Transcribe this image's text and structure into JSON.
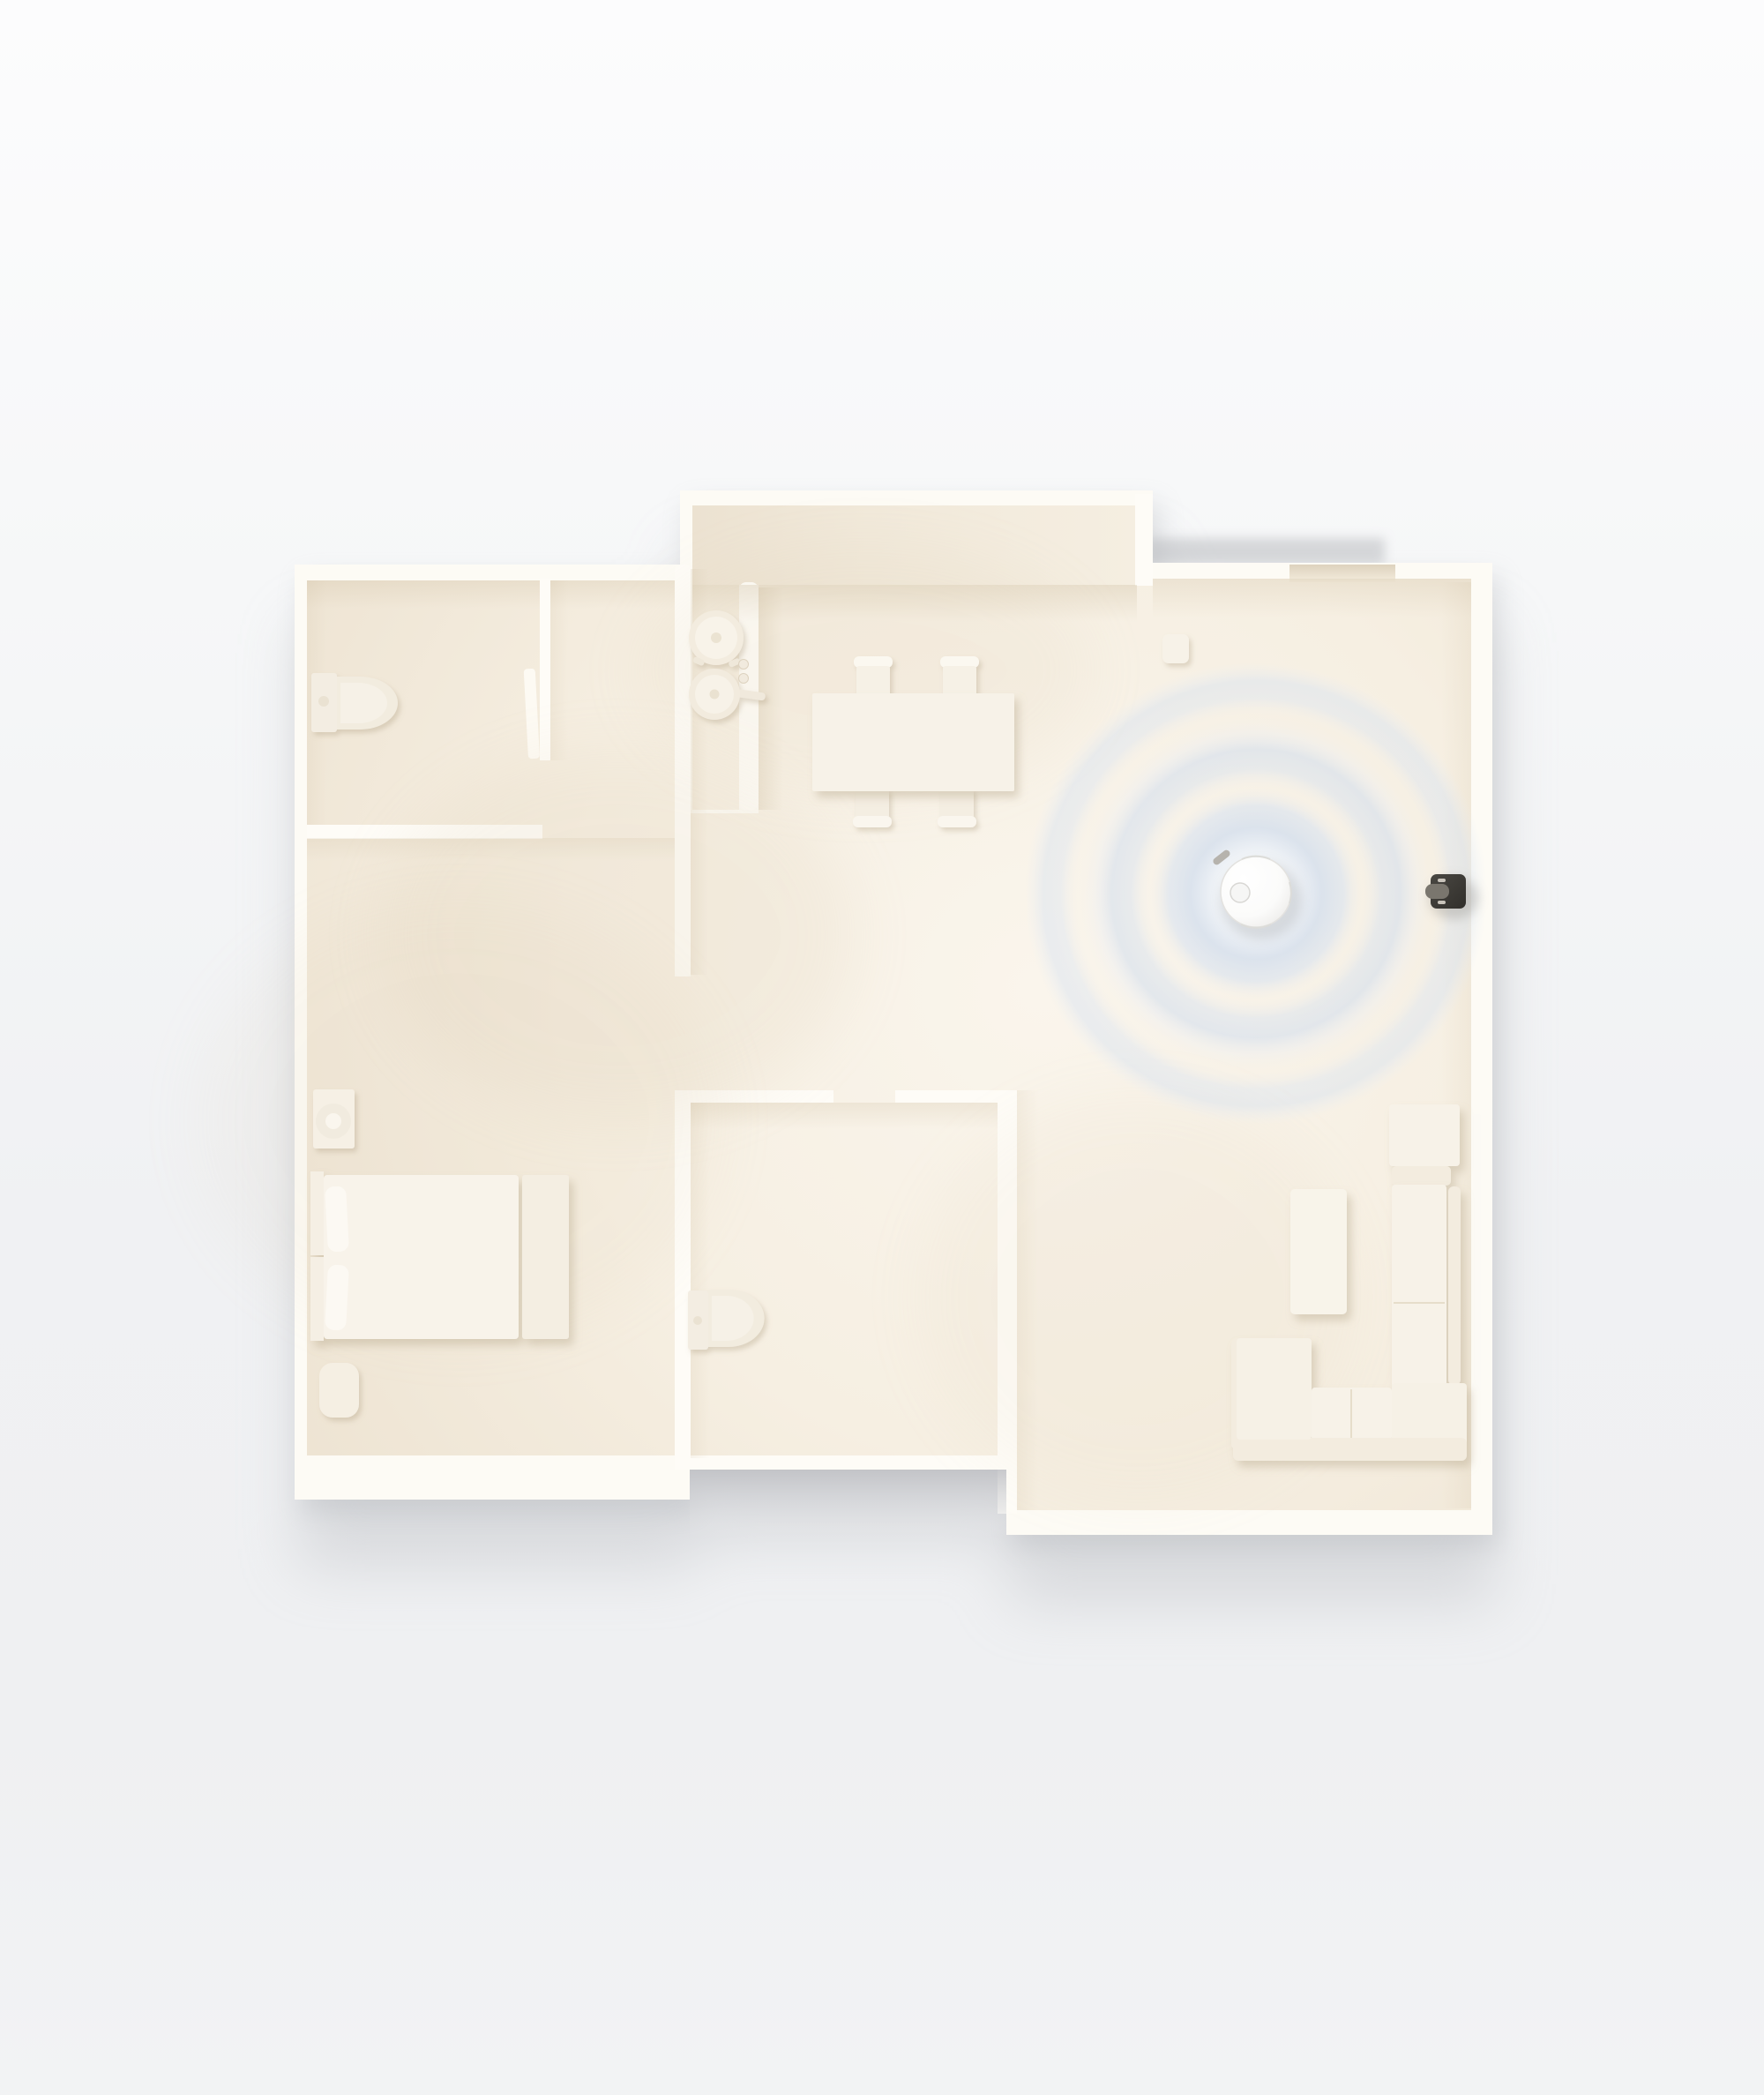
{
  "scene": {
    "description": "Top-down 3D render of a cream apartment floor plan; a round white robot vacuum in the living area emits three concentric blue LiDAR mapping rings toward a dark charging dock mounted on the right wall",
    "rooms": [
      {
        "label": "bathroom"
      },
      {
        "label": "closet"
      },
      {
        "label": "kitchen"
      },
      {
        "label": "dining-area"
      },
      {
        "label": "hallway"
      },
      {
        "label": "bedroom"
      },
      {
        "label": "ensuite-bathroom"
      },
      {
        "label": "living-room"
      },
      {
        "label": "entry"
      }
    ],
    "furniture": [
      {
        "label": "toilet"
      },
      {
        "label": "stove-pot"
      },
      {
        "label": "stove-pan"
      },
      {
        "label": "stove-knobs"
      },
      {
        "label": "dining-table"
      },
      {
        "label": "dining-chairs"
      },
      {
        "label": "bed"
      },
      {
        "label": "pillows"
      },
      {
        "label": "nightstand"
      },
      {
        "label": "table-lamp"
      },
      {
        "label": "ottoman"
      },
      {
        "label": "ensuite-toilet"
      },
      {
        "label": "sectional-sofa"
      },
      {
        "label": "armchair"
      },
      {
        "label": "coffee-table"
      },
      {
        "label": "sofa-ottoman"
      },
      {
        "label": "entry-stool"
      },
      {
        "label": "sliding-door"
      }
    ],
    "device": {
      "name": "robot-vacuum",
      "parts": [
        "lidar-turret",
        "side-brush"
      ],
      "accessory": "charging-dock",
      "effect": "lidar-scan-rings",
      "ring_count": 3
    }
  },
  "colors": {
    "background": "#f2f3f5",
    "background_shadow": "#aeb1b6",
    "wall": "#fdfbf5",
    "wall_bright": "#fffdf8",
    "wall_face": "#f1e9da",
    "floor_light": "#faf5ec",
    "floor_mid": "#f5eee1",
    "floor_dark": "#eee5d4",
    "counter": "#f0e8d9",
    "furniture": "#f7f2e8",
    "furniture_shade": "#e9e0cd",
    "ring_blue": "#d5dfee",
    "ring_blue_light": "#e9eef6",
    "robot_white": "#ffffff",
    "robot_rim": "#e3e2df",
    "dock_dark": "#3b3935",
    "dock_slot": "#c9c4bb",
    "shadow_warm": "#c9b896",
    "notch_shadow": "#c6c7ca"
  }
}
